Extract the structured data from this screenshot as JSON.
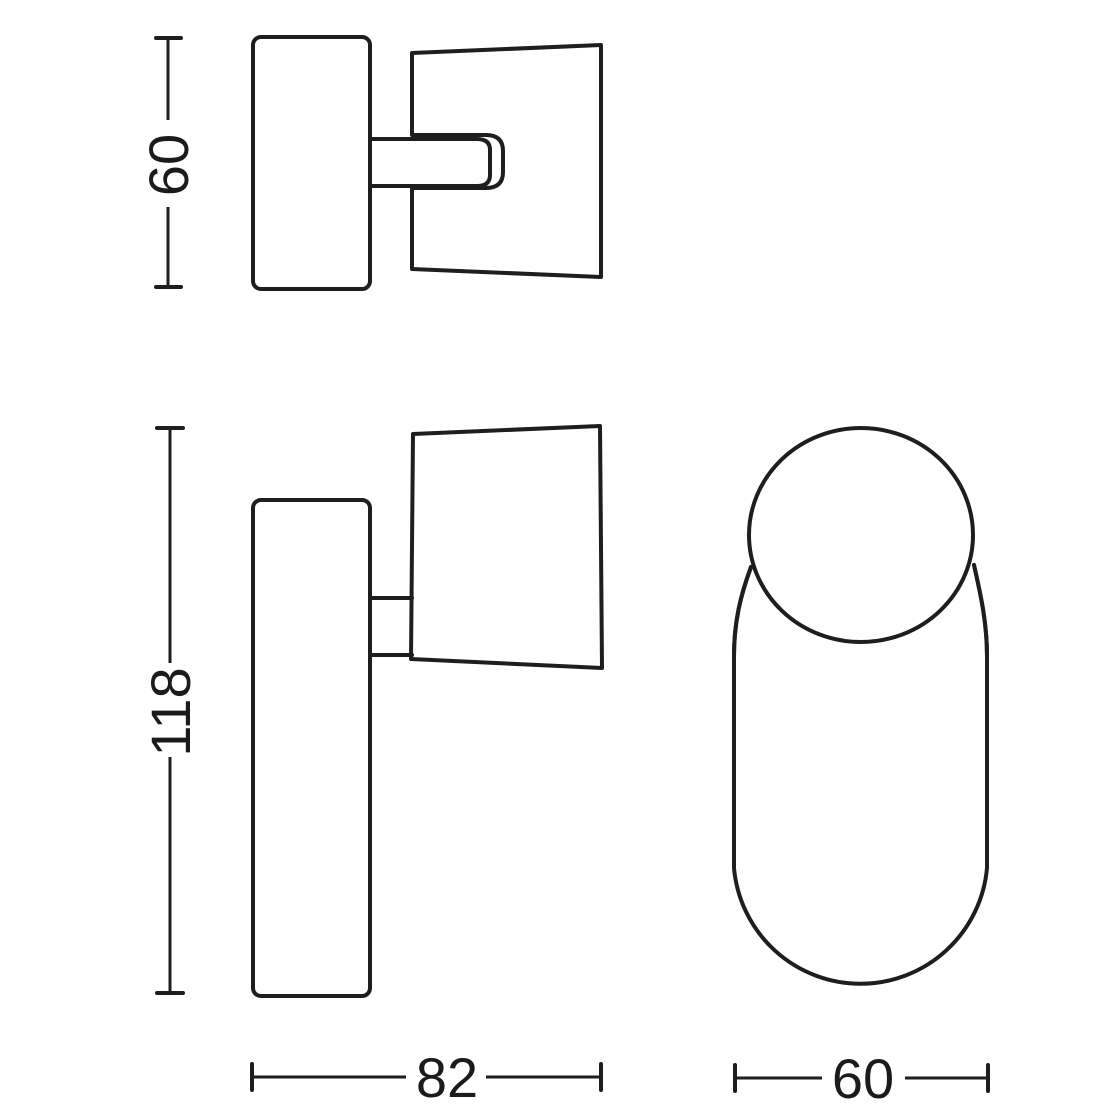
{
  "drawing": {
    "background_color": "#ffffff",
    "line_color": "#1e1e1e",
    "text_color": "#1b1b1b",
    "views": {
      "top_view": {
        "height_dimension": "60"
      },
      "front_view": {
        "height_dimension": "118",
        "width_dimension": "82"
      },
      "side_view": {
        "width_dimension": "60"
      }
    }
  }
}
